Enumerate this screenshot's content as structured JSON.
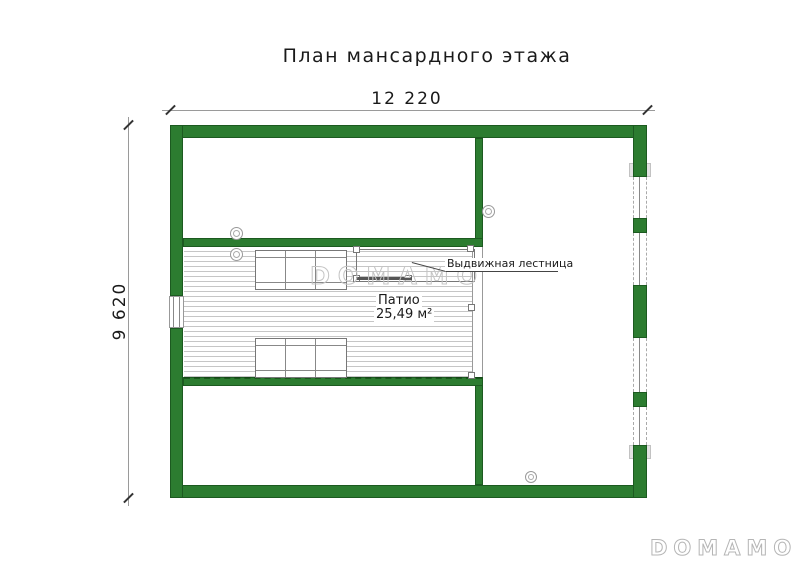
{
  "title": "План мансардного этажа",
  "dimensions": {
    "width": "12 220",
    "height": "9 620"
  },
  "rooms": {
    "patio": {
      "name": "Патио",
      "area": "25,49 м²"
    }
  },
  "annotations": {
    "ladder": "Выдвижная лестница"
  },
  "watermark": {
    "center": "DOMAMO",
    "corner": "DOMAMO"
  },
  "colors": {
    "wall_fill": "#2c7c30",
    "wall_edge": "#1c5a20",
    "dimension_line": "#9a9a9a",
    "text": "#1a1a1a",
    "deck_stripe": "#c6c6c6",
    "watermark_outline": "#c4c4c4"
  }
}
